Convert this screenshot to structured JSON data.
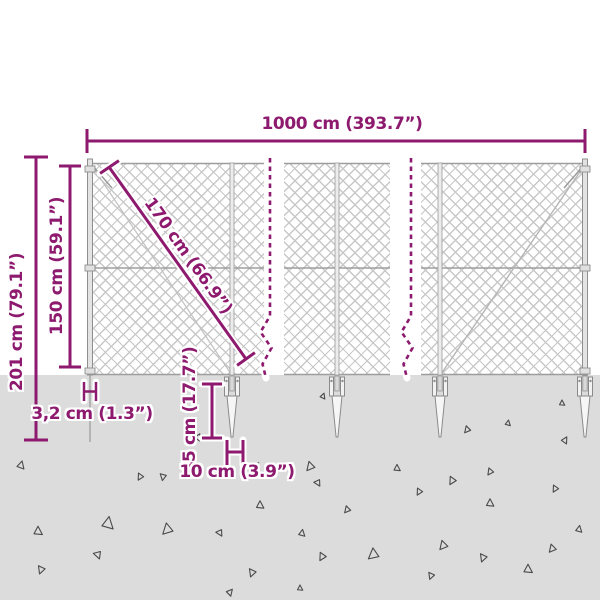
{
  "colors": {
    "accent": "#8d1a6e",
    "ground": "#dcdcdc",
    "mesh_line": "#c8c8c8",
    "triangle_outline": "#4a4a4a"
  },
  "labels": {
    "total_width": "1000 cm (393.7”)",
    "total_height": "201 cm (79.1”)",
    "fence_height": "150 cm (59.1”)",
    "diagonal": "170 cm (66.9”)",
    "anchor_depth": "45 cm (17.7”)",
    "anchor_width": "10 cm (3.9”)",
    "post_diameter": "3,2 cm (1.3”)"
  },
  "spike_positions": [
    232,
    337,
    440,
    585
  ],
  "ground_triangles": [
    {
      "x": 21,
      "y": 465,
      "s": 7,
      "r": 15
    },
    {
      "x": 38,
      "y": 531,
      "s": 8,
      "r": 0
    },
    {
      "x": 41,
      "y": 570,
      "s": 7,
      "r": 200
    },
    {
      "x": 98,
      "y": 555,
      "s": 7,
      "r": 160
    },
    {
      "x": 108,
      "y": 523,
      "s": 11,
      "r": 10
    },
    {
      "x": 140,
      "y": 477,
      "s": 6,
      "r": 210
    },
    {
      "x": 163,
      "y": 477,
      "s": 6,
      "r": 190
    },
    {
      "x": 167,
      "y": 530,
      "s": 10,
      "r": 225
    },
    {
      "x": 198,
      "y": 437,
      "s": 6,
      "r": 30
    },
    {
      "x": 220,
      "y": 533,
      "s": 6,
      "r": 150
    },
    {
      "x": 256,
      "y": 466,
      "s": 7,
      "r": 40
    },
    {
      "x": 260,
      "y": 505,
      "s": 7,
      "r": 0
    },
    {
      "x": 302,
      "y": 533,
      "s": 6,
      "r": 10
    },
    {
      "x": 310,
      "y": 467,
      "s": 8,
      "r": 220
    },
    {
      "x": 318,
      "y": 483,
      "s": 6,
      "r": 150
    },
    {
      "x": 322,
      "y": 557,
      "s": 7,
      "r": 210
    },
    {
      "x": 323,
      "y": 396,
      "s": 5,
      "r": 20
    },
    {
      "x": 347,
      "y": 510,
      "s": 6,
      "r": 220
    },
    {
      "x": 373,
      "y": 555,
      "s": 10,
      "r": 230
    },
    {
      "x": 252,
      "y": 573,
      "s": 7,
      "r": 200
    },
    {
      "x": 397,
      "y": 468,
      "s": 6,
      "r": 0
    },
    {
      "x": 419,
      "y": 492,
      "s": 6,
      "r": 210
    },
    {
      "x": 431,
      "y": 576,
      "s": 6,
      "r": 200
    },
    {
      "x": 443,
      "y": 546,
      "s": 8,
      "r": 220
    },
    {
      "x": 452,
      "y": 481,
      "s": 7,
      "r": 210
    },
    {
      "x": 467,
      "y": 430,
      "s": 6,
      "r": 220
    },
    {
      "x": 483,
      "y": 558,
      "s": 7,
      "r": 200
    },
    {
      "x": 490,
      "y": 472,
      "s": 6,
      "r": 215
    },
    {
      "x": 490,
      "y": 503,
      "s": 7,
      "r": 0
    },
    {
      "x": 508,
      "y": 423,
      "s": 5,
      "r": 10
    },
    {
      "x": 528,
      "y": 569,
      "s": 8,
      "r": 0
    },
    {
      "x": 552,
      "y": 549,
      "s": 7,
      "r": 220
    },
    {
      "x": 555,
      "y": 489,
      "s": 6,
      "r": 210
    },
    {
      "x": 562,
      "y": 403,
      "s": 5,
      "r": 0
    },
    {
      "x": 579,
      "y": 529,
      "s": 6,
      "r": 10
    },
    {
      "x": 565,
      "y": 440,
      "s": 6,
      "r": 30
    },
    {
      "x": 230,
      "y": 592,
      "s": 6,
      "r": 40
    },
    {
      "x": 300,
      "y": 588,
      "s": 5,
      "r": 0
    }
  ]
}
